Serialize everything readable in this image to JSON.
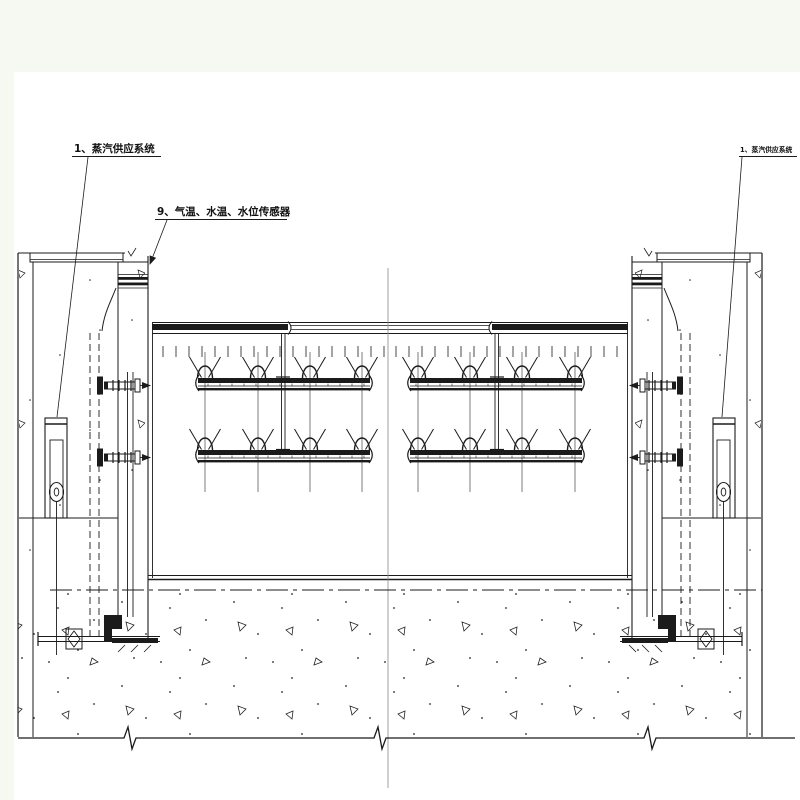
{
  "page": {
    "background_color": "#f6f9f1",
    "paper_color": "#ffffff",
    "line_color": "#1b1b1b",
    "centerline_color": "#8a8a8a"
  },
  "drawing": {
    "type": "engineering-elevation-gate-heating-system",
    "labels": [
      {
        "id": "steam-supply-left",
        "text": "1、蒸汽供应系统"
      },
      {
        "id": "sensors",
        "text": "9、气温、水温、水位传感器"
      },
      {
        "id": "steam-supply-right",
        "text": "1、蒸汽供应系统"
      }
    ],
    "symbols": {
      "nozzle": "steam-spray-nozzle-icon",
      "valve": "gate-valve-icon",
      "concrete": "concrete-stipple-hatch",
      "break": "break-line-zigzag"
    }
  }
}
